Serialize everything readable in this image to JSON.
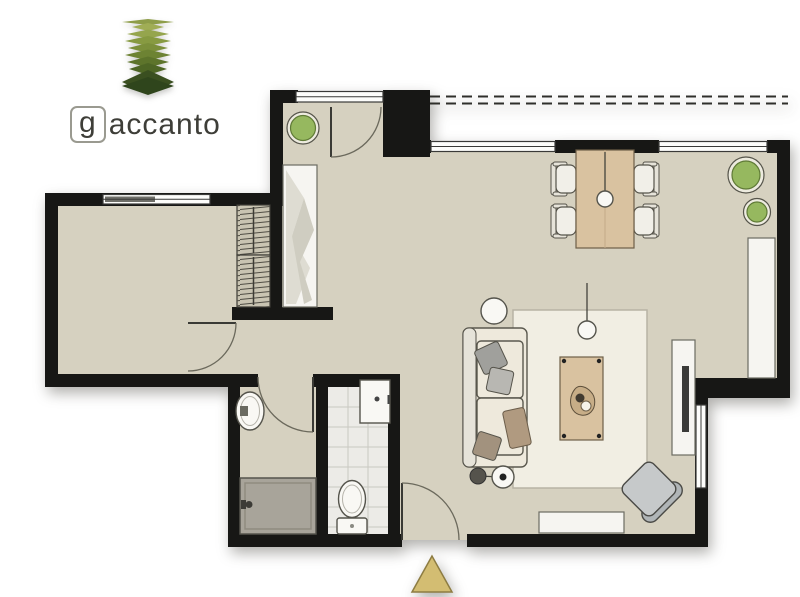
{
  "logo": {
    "initial": "g",
    "name": "accanto",
    "icon": "stacked-leaves-icon",
    "leaf_layers": [
      {
        "hw": 26,
        "y": 8,
        "h": 6,
        "c": "#8e9d49"
      },
      {
        "hw": 16,
        "y": 13,
        "h": 8,
        "c": "#a0ad55"
      },
      {
        "hw": 21,
        "y": 20,
        "h": 9,
        "c": "#95a54d"
      },
      {
        "hw": 23,
        "y": 27,
        "h": 10,
        "c": "#879a41"
      },
      {
        "hw": 20,
        "y": 34,
        "h": 10,
        "c": "#7b8f3a"
      },
      {
        "hw": 23,
        "y": 41,
        "h": 11,
        "c": "#6d8333"
      },
      {
        "hw": 21,
        "y": 48,
        "h": 11,
        "c": "#5d742b"
      },
      {
        "hw": 19,
        "y": 55,
        "h": 12,
        "c": "#4e6625"
      },
      {
        "hw": 26,
        "y": 68,
        "h": 24,
        "c": "#3a4f20"
      },
      {
        "hw": 26,
        "y": 72,
        "h": 18,
        "c": "#2f451c"
      }
    ]
  },
  "colors": {
    "logo_text": "#3e3e38",
    "logo_box": "#9a9a90",
    "wall": "#171715",
    "floor": "#d6d1c0",
    "wood": "#d9c2a0",
    "rug": "#f1eee3",
    "white_furniture": "#f6f5f1",
    "tile": "#ecebe7",
    "tile_line": "#c9c8c2",
    "shower": "#a8a49a",
    "plant": "#96b85f",
    "sofa": "#eee9dc",
    "armchair": "#c6c9ca",
    "armchair_back": "#b0b5b7",
    "tv": "#3a3a38",
    "triangle": "#d3bd72",
    "triangle_border": "#8d7c42"
  },
  "plan": {
    "entrance_marker": "triangle-up-icon"
  }
}
